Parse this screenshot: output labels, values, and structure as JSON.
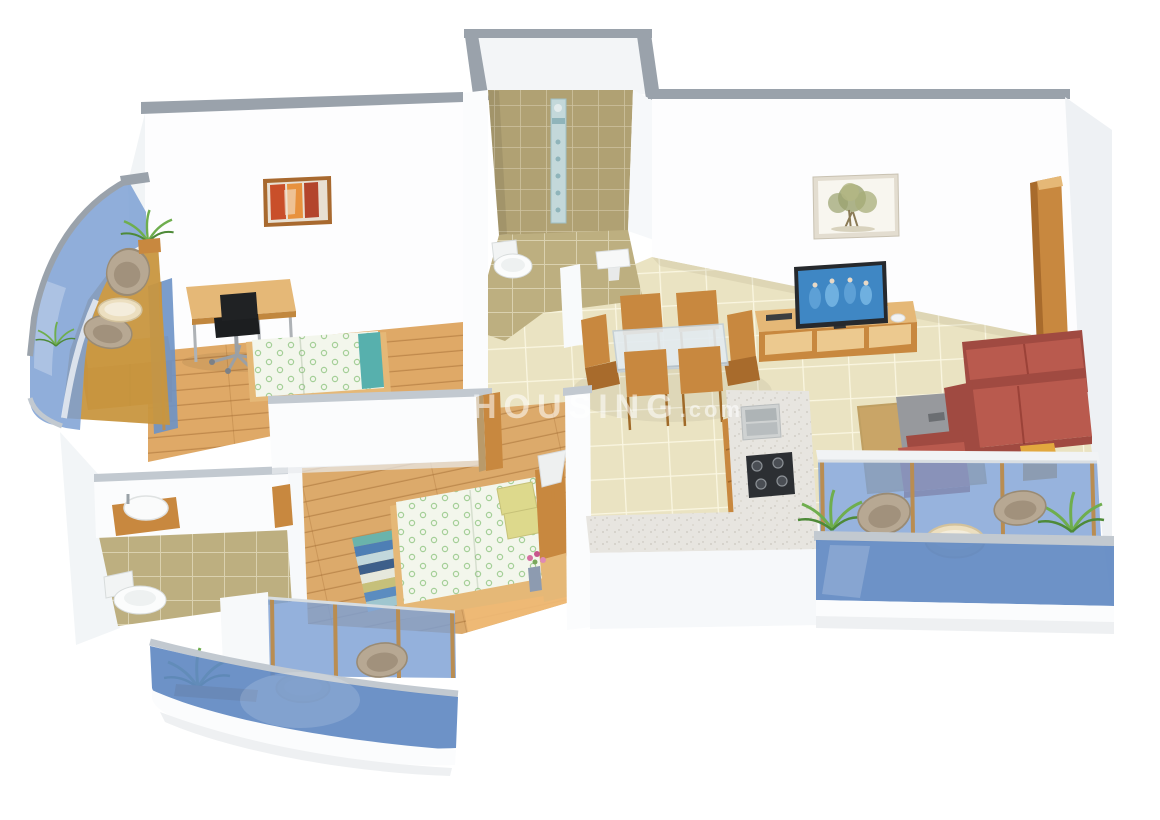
{
  "watermark": {
    "text": "HOUSING",
    "suffix": ".com"
  },
  "palette": {
    "wall": "#fbfcfd",
    "wallShade": "#eef1f4",
    "cap": "#9aa2ab",
    "capLight": "#c2c9d0",
    "woodFloor": "#dfa967",
    "woodFloor2": "#dcaa6b",
    "tile": "#eae3c2",
    "oliveWall": "#b0a173",
    "oliveFloor": "#bdaf80",
    "glass": "#7da0d4",
    "glassDeep": "#6189c2",
    "wood": "#c8883f",
    "woodDark": "#a86b2c",
    "woodLight": "#e5b877",
    "sofa": "#b95a4e",
    "sofaDark": "#a04a41",
    "wicker": "#b7a893",
    "mattress": "#f3f6ec",
    "mattressDot": "#a4cf97",
    "pillow": "#ddd98c",
    "rugTan": "#c9a567",
    "tableGray": "#97999d",
    "granite": "#e7e5e0",
    "screenBlue": "#3f87c4",
    "plant": "#6fae4e",
    "lamp": "#eef0f0",
    "watermark": "rgba(255,255,255,0.55)"
  },
  "scene": {
    "description": "3D isometric render of a 2BHK apartment floor plan",
    "rooms": [
      {
        "id": "bedroom-1",
        "items": [
          "double-bed",
          "study-desk",
          "office-chair",
          "wardrobe",
          "wall-painting"
        ]
      },
      {
        "id": "bathroom-1",
        "items": [
          "shower-panel",
          "toilet",
          "wash-basin"
        ]
      },
      {
        "id": "master-balcony",
        "items": [
          "wicker-chairs",
          "round-table",
          "plants",
          "glass-railing"
        ]
      },
      {
        "id": "living-room",
        "items": [
          "sofa",
          "armchair",
          "coffee-table",
          "rug",
          "tv",
          "tv-unit",
          "side-table",
          "wall-painting",
          "entrance-door"
        ]
      },
      {
        "id": "dining-area",
        "items": [
          "glass-dining-table",
          "six-wooden-chairs"
        ]
      },
      {
        "id": "kitchen",
        "items": [
          "l-shaped-counter",
          "double-sink",
          "gas-hob",
          "wooden-cabinets"
        ]
      },
      {
        "id": "bedroom-2",
        "items": [
          "double-bed",
          "table-lamp",
          "striped-rug",
          "flower-vase"
        ]
      },
      {
        "id": "bathroom-2",
        "items": [
          "toilet",
          "wash-basin"
        ]
      },
      {
        "id": "living-balcony",
        "items": [
          "wicker-chairs",
          "round-table",
          "plants",
          "glass-railing"
        ]
      },
      {
        "id": "lower-balcony",
        "items": [
          "wicker-chair",
          "round-table",
          "plant",
          "glass-railing"
        ]
      }
    ]
  }
}
